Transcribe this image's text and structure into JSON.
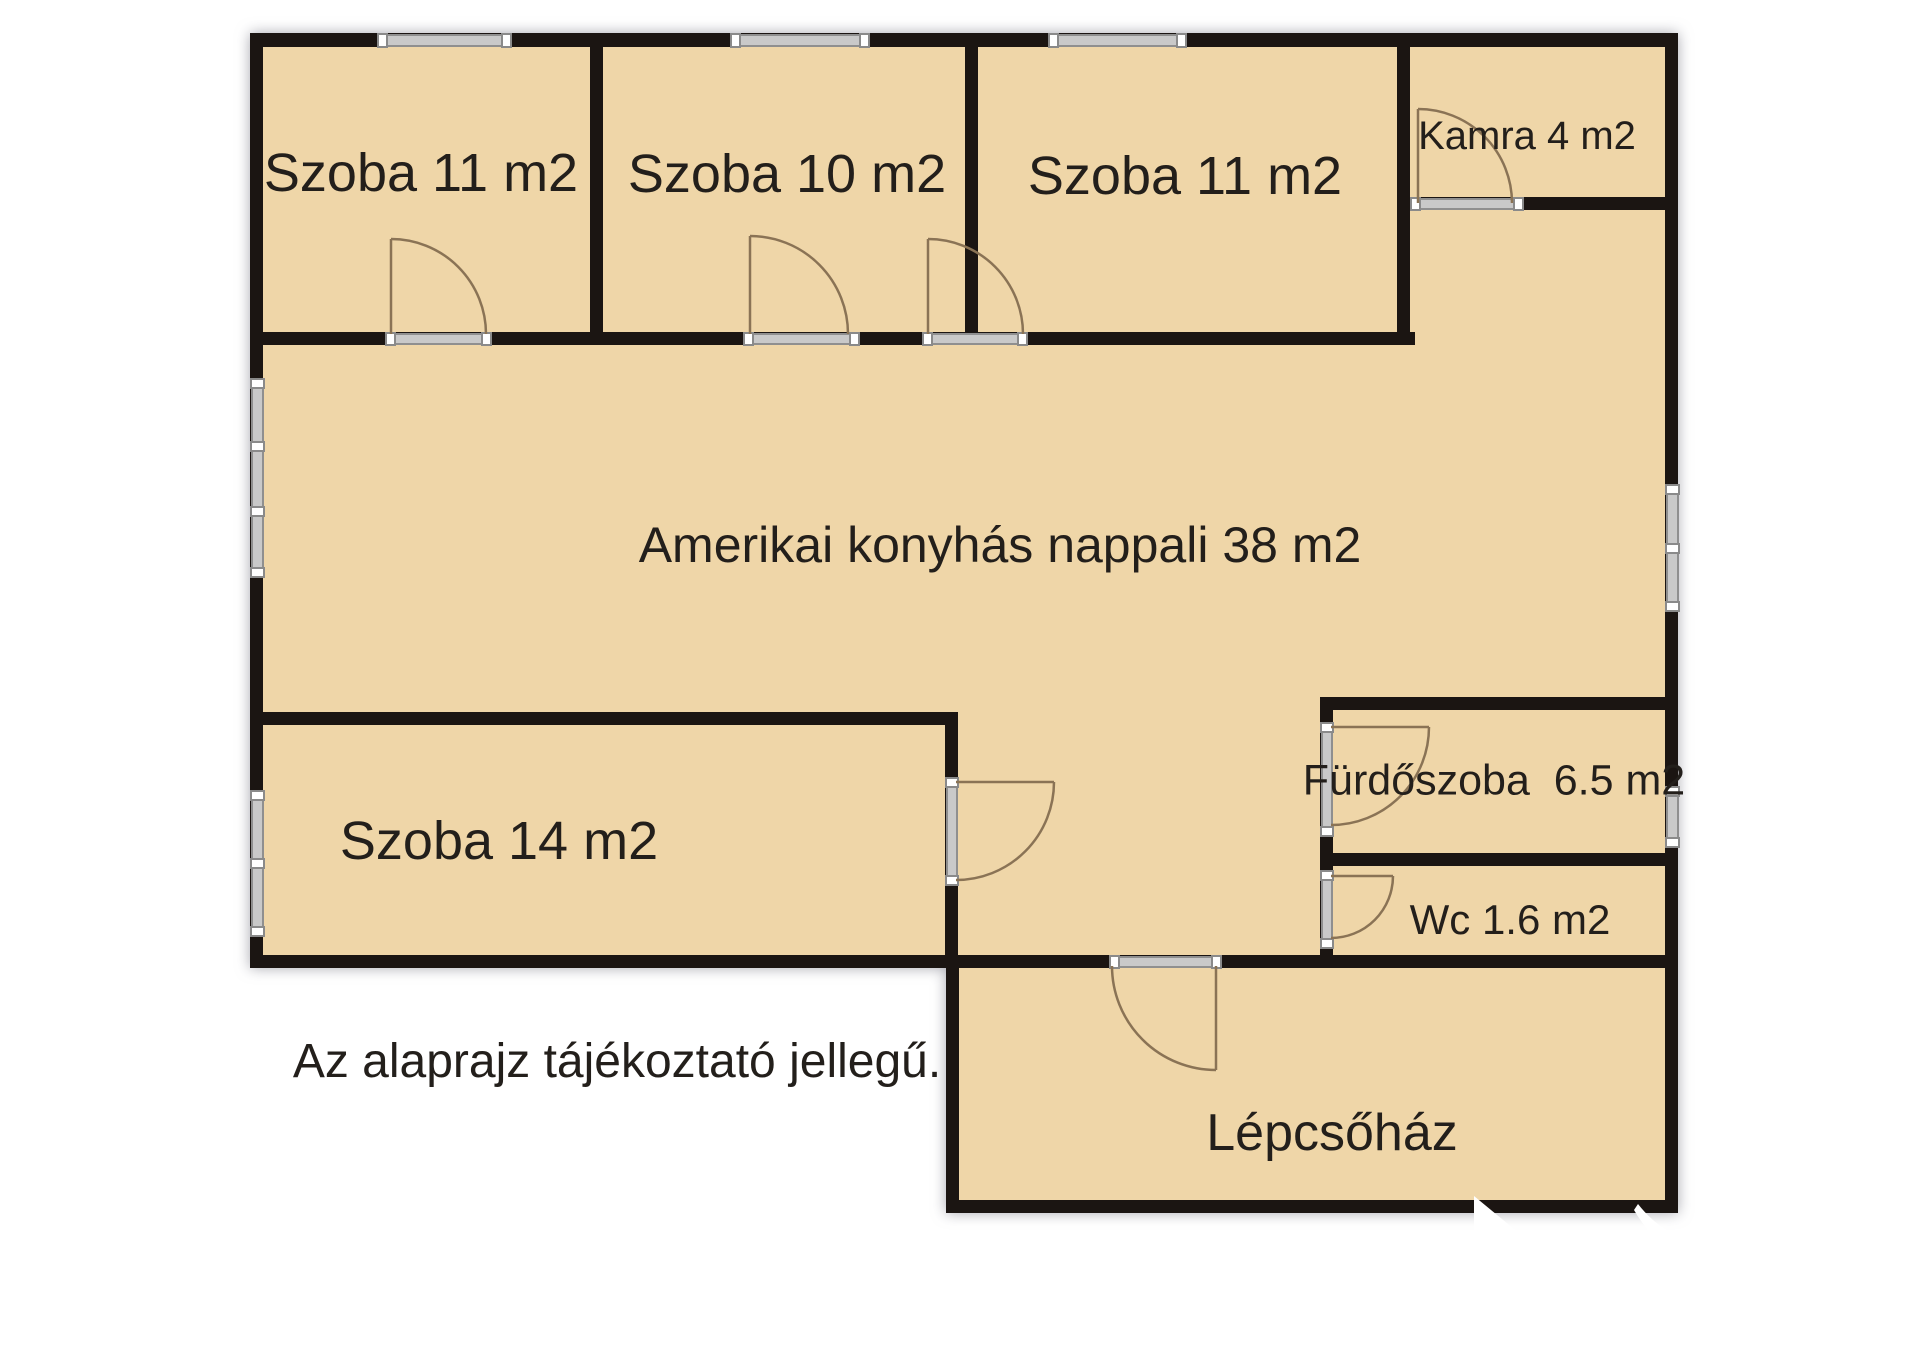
{
  "floorplan": {
    "rooms": [
      {
        "id": "szoba-1",
        "label": "Szoba 11 m2"
      },
      {
        "id": "szoba-2",
        "label": "Szoba 10 m2"
      },
      {
        "id": "szoba-3",
        "label": "Szoba 11 m2"
      },
      {
        "id": "kamra",
        "label": "Kamra 4 m2"
      },
      {
        "id": "nappali",
        "label": "Amerikai konyhás nappali 38 m2"
      },
      {
        "id": "szoba-4",
        "label": "Szoba 14 m2"
      },
      {
        "id": "furdoszoba",
        "label": "Fürdőszoba  6.5 m2"
      },
      {
        "id": "wc",
        "label": "Wc 1.6 m2"
      },
      {
        "id": "lepcsohaz",
        "label": "Lépcsőház"
      }
    ],
    "note": "Az alaprajz tájékoztató jellegű.",
    "colors": {
      "room_fill": "#efd6a8",
      "wall": "#1b1512",
      "door_line": "#8a7355",
      "window_fill": "#c9c9c9",
      "window_cap": "#ffffff",
      "text": "#231f1b",
      "outside": "#ffffff"
    }
  }
}
